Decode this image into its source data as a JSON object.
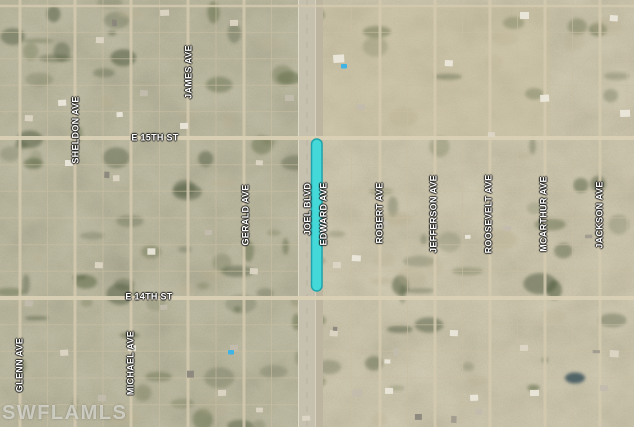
{
  "map": {
    "kind": "satellite-parcel-map",
    "watermark": "SWFLAMLS",
    "highlight": {
      "color": "#3EDADC",
      "border_color": "#17A3AB",
      "along": "EDWARD AVE",
      "between": [
        "E 15TH ST",
        "E 14TH ST"
      ]
    },
    "street_labels": [
      {
        "name": "GLENN AVE",
        "orientation": "vertical",
        "x": 20,
        "y": 365
      },
      {
        "name": "SHELDON AVE",
        "orientation": "vertical",
        "x": 76,
        "y": 130
      },
      {
        "name": "MICHAEL AVE",
        "orientation": "vertical",
        "x": 131,
        "y": 363
      },
      {
        "name": "JAMES AVE",
        "orientation": "vertical",
        "x": 189,
        "y": 72
      },
      {
        "name": "GERALD AVE",
        "orientation": "vertical",
        "x": 246,
        "y": 215
      },
      {
        "name": "JOEL BLVD",
        "orientation": "vertical",
        "x": 308,
        "y": 209
      },
      {
        "name": "EDWARD AVE",
        "orientation": "vertical",
        "x": 324,
        "y": 214
      },
      {
        "name": "ROBERT AVE",
        "orientation": "vertical",
        "x": 380,
        "y": 213
      },
      {
        "name": "JEFFERSON AVE",
        "orientation": "vertical",
        "x": 434,
        "y": 214
      },
      {
        "name": "ROOSEVELT AVE",
        "orientation": "vertical",
        "x": 489,
        "y": 214
      },
      {
        "name": "MCARTHUR AVE",
        "orientation": "vertical",
        "x": 544,
        "y": 214
      },
      {
        "name": "JACKSON AVE",
        "orientation": "vertical",
        "x": 600,
        "y": 215
      },
      {
        "name": "E 15TH ST",
        "orientation": "horizontal",
        "x": 155,
        "y": 138
      },
      {
        "name": "E 14TH ST",
        "orientation": "horizontal",
        "x": 149,
        "y": 297
      }
    ]
  }
}
